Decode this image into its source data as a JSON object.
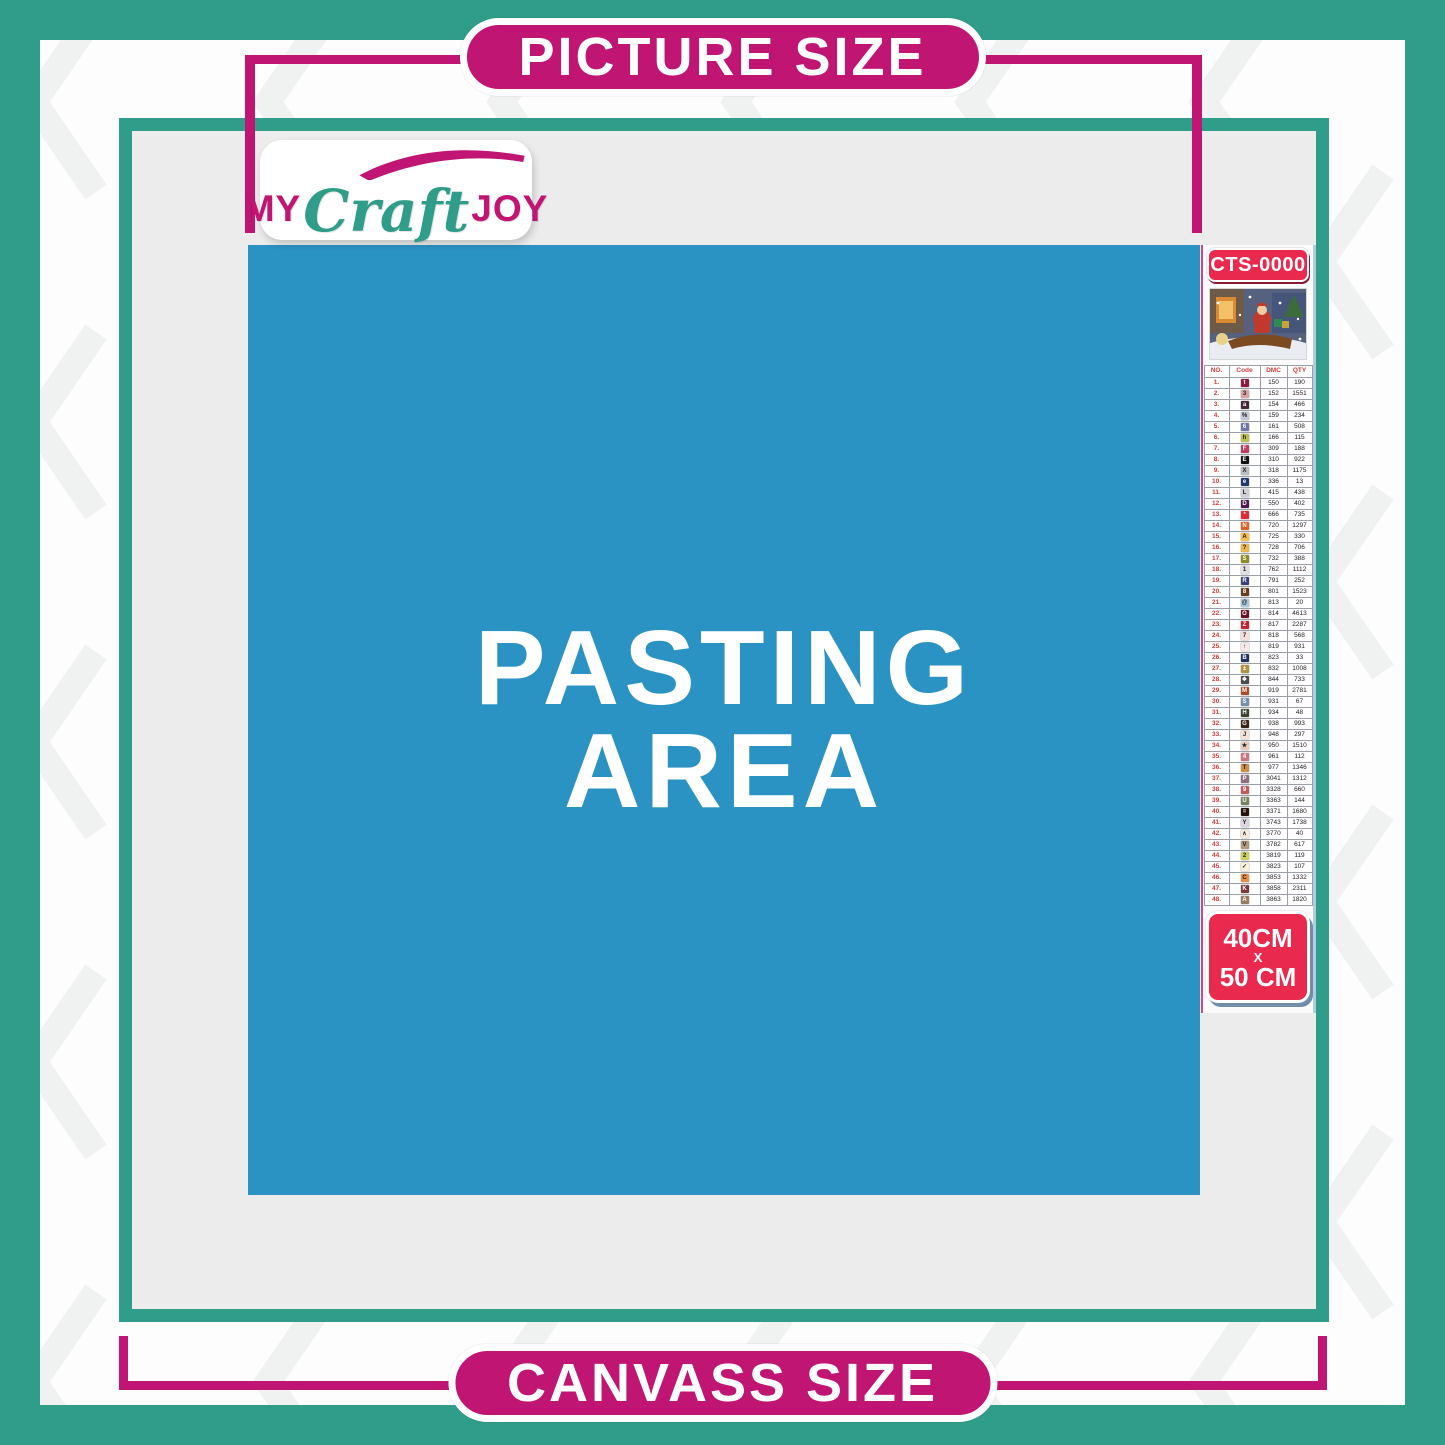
{
  "banners": {
    "top": "PICTURE SIZE",
    "bottom": "CANVASS SIZE"
  },
  "logo": {
    "word1": "MY",
    "word2": "Craft",
    "word3": "JOY"
  },
  "pasting_area": {
    "line1": "PASTING",
    "line2": "AREA"
  },
  "legend": {
    "kit_code": "CTS-0000",
    "size_badge": {
      "width": "40CM",
      "separator": "X",
      "height": "50 CM"
    },
    "table": {
      "headers": [
        "NO.",
        "Code",
        "DMC",
        "QTY"
      ],
      "rows": [
        {
          "no": "1.",
          "symbol": "t",
          "color": "#8F1B42",
          "dmc": "150",
          "qty": "190"
        },
        {
          "no": "2.",
          "symbol": "3",
          "color": "#D9A3A4",
          "dmc": "152",
          "qty": "1551"
        },
        {
          "no": "3.",
          "symbol": "a",
          "color": "#472436",
          "dmc": "154",
          "qty": "466"
        },
        {
          "no": "4.",
          "symbol": "%",
          "color": "#C5C8D8",
          "dmc": "159",
          "qty": "234"
        },
        {
          "no": "5.",
          "symbol": "6",
          "color": "#6F77A5",
          "dmc": "161",
          "qty": "508"
        },
        {
          "no": "6.",
          "symbol": "h",
          "color": "#BDC14B",
          "dmc": "166",
          "qty": "115"
        },
        {
          "no": "7.",
          "symbol": "F",
          "color": "#C23B5E",
          "dmc": "309",
          "qty": "188"
        },
        {
          "no": "8.",
          "symbol": "E",
          "color": "#111111",
          "dmc": "310",
          "qty": "922"
        },
        {
          "no": "9.",
          "symbol": "X",
          "color": "#BDBDBF",
          "dmc": "318",
          "qty": "1175"
        },
        {
          "no": "10.",
          "symbol": "e",
          "color": "#22396B",
          "dmc": "336",
          "qty": "13"
        },
        {
          "no": "11.",
          "symbol": "L",
          "color": "#CFCFD5",
          "dmc": "415",
          "qty": "438"
        },
        {
          "no": "12.",
          "symbol": "D",
          "color": "#4E1A55",
          "dmc": "550",
          "qty": "402"
        },
        {
          "no": "13.",
          "symbol": "*",
          "color": "#DE2B36",
          "dmc": "666",
          "qty": "735"
        },
        {
          "no": "14.",
          "symbol": "N",
          "color": "#E2601F",
          "dmc": "720",
          "qty": "1297"
        },
        {
          "no": "15.",
          "symbol": "A",
          "color": "#F6BE4B",
          "dmc": "725",
          "qty": "330"
        },
        {
          "no": "16.",
          "symbol": "?",
          "color": "#EFB54A",
          "dmc": "728",
          "qty": "706"
        },
        {
          "no": "17.",
          "symbol": "S",
          "color": "#8E8B1F",
          "dmc": "732",
          "qty": "388"
        },
        {
          "no": "18.",
          "symbol": "1",
          "color": "#DEDEDE",
          "dmc": "762",
          "qty": "1112"
        },
        {
          "no": "19.",
          "symbol": "R",
          "color": "#3C3E79",
          "dmc": "791",
          "qty": "252"
        },
        {
          "no": "20.",
          "symbol": "8",
          "color": "#6A3C1E",
          "dmc": "801",
          "qty": "1523"
        },
        {
          "no": "21.",
          "symbol": "@",
          "color": "#A8CAE1",
          "dmc": "813",
          "qty": "20"
        },
        {
          "no": "22.",
          "symbol": "O",
          "color": "#700F28",
          "dmc": "814",
          "qty": "4613"
        },
        {
          "no": "23.",
          "symbol": "Z",
          "color": "#C5252E",
          "dmc": "817",
          "qty": "2287"
        },
        {
          "no": "24.",
          "symbol": "7",
          "color": "#F7DEDF",
          "dmc": "818",
          "qty": "568"
        },
        {
          "no": "25.",
          "symbol": "↑",
          "color": "#F6E9E8",
          "dmc": "819",
          "qty": "931"
        },
        {
          "no": "26.",
          "symbol": "B",
          "color": "#20305F",
          "dmc": "823",
          "qty": "33"
        },
        {
          "no": "27.",
          "symbol": "±",
          "color": "#B3903C",
          "dmc": "832",
          "qty": "1008"
        },
        {
          "no": "28.",
          "symbol": "❖",
          "color": "#4C4C4C",
          "dmc": "844",
          "qty": "733"
        },
        {
          "no": "29.",
          "symbol": "M",
          "color": "#B24A2A",
          "dmc": "919",
          "qty": "2781"
        },
        {
          "no": "30.",
          "symbol": "S",
          "color": "#7290AA",
          "dmc": "931",
          "qty": "67"
        },
        {
          "no": "31.",
          "symbol": "H",
          "color": "#3D4331",
          "dmc": "934",
          "qty": "48"
        },
        {
          "no": "32.",
          "symbol": "G",
          "color": "#3A2514",
          "dmc": "938",
          "qty": "993"
        },
        {
          "no": "33.",
          "symbol": "J",
          "color": "#F6E1D3",
          "dmc": "948",
          "qty": "297"
        },
        {
          "no": "34.",
          "symbol": "★",
          "color": "#E8CCB8",
          "dmc": "950",
          "qty": "1510"
        },
        {
          "no": "35.",
          "symbol": "4",
          "color": "#CC7480",
          "dmc": "961",
          "qty": "112"
        },
        {
          "no": "36.",
          "symbol": "T",
          "color": "#CE9040",
          "dmc": "977",
          "qty": "1346"
        },
        {
          "no": "37.",
          "symbol": "P",
          "color": "#8E6F80",
          "dmc": "3041",
          "qty": "1312"
        },
        {
          "no": "38.",
          "symbol": "9",
          "color": "#C25A5C",
          "dmc": "3328",
          "qty": "660"
        },
        {
          "no": "39.",
          "symbol": "U",
          "color": "#75845B",
          "dmc": "3363",
          "qty": "144"
        },
        {
          "no": "40.",
          "symbol": "=",
          "color": "#241409",
          "dmc": "3371",
          "qty": "1680"
        },
        {
          "no": "41.",
          "symbol": "Y",
          "color": "#DBD3E0",
          "dmc": "3743",
          "qty": "1738"
        },
        {
          "no": "42.",
          "symbol": "∧",
          "color": "#F8EADC",
          "dmc": "3770",
          "qty": "40"
        },
        {
          "no": "43.",
          "symbol": "V",
          "color": "#B29A7E",
          "dmc": "3782",
          "qty": "617"
        },
        {
          "no": "44.",
          "symbol": "2",
          "color": "#CDD25A",
          "dmc": "3819",
          "qty": "119"
        },
        {
          "no": "45.",
          "symbol": "✓",
          "color": "#FAF3D7",
          "dmc": "3823",
          "qty": "107"
        },
        {
          "no": "46.",
          "symbol": "C",
          "color": "#EC8E3E",
          "dmc": "3853",
          "qty": "1332"
        },
        {
          "no": "47.",
          "symbol": "K",
          "color": "#7D3B37",
          "dmc": "3858",
          "qty": "2311"
        },
        {
          "no": "48.",
          "symbol": "A",
          "color": "#987C61",
          "dmc": "3863",
          "qty": "1820"
        }
      ]
    }
  },
  "colors": {
    "teal": "#2F9D89",
    "magenta": "#C01573",
    "pasting_blue": "#2B92C4",
    "canvas_grey": "#ECECED",
    "badge_red": "#E9294E"
  }
}
